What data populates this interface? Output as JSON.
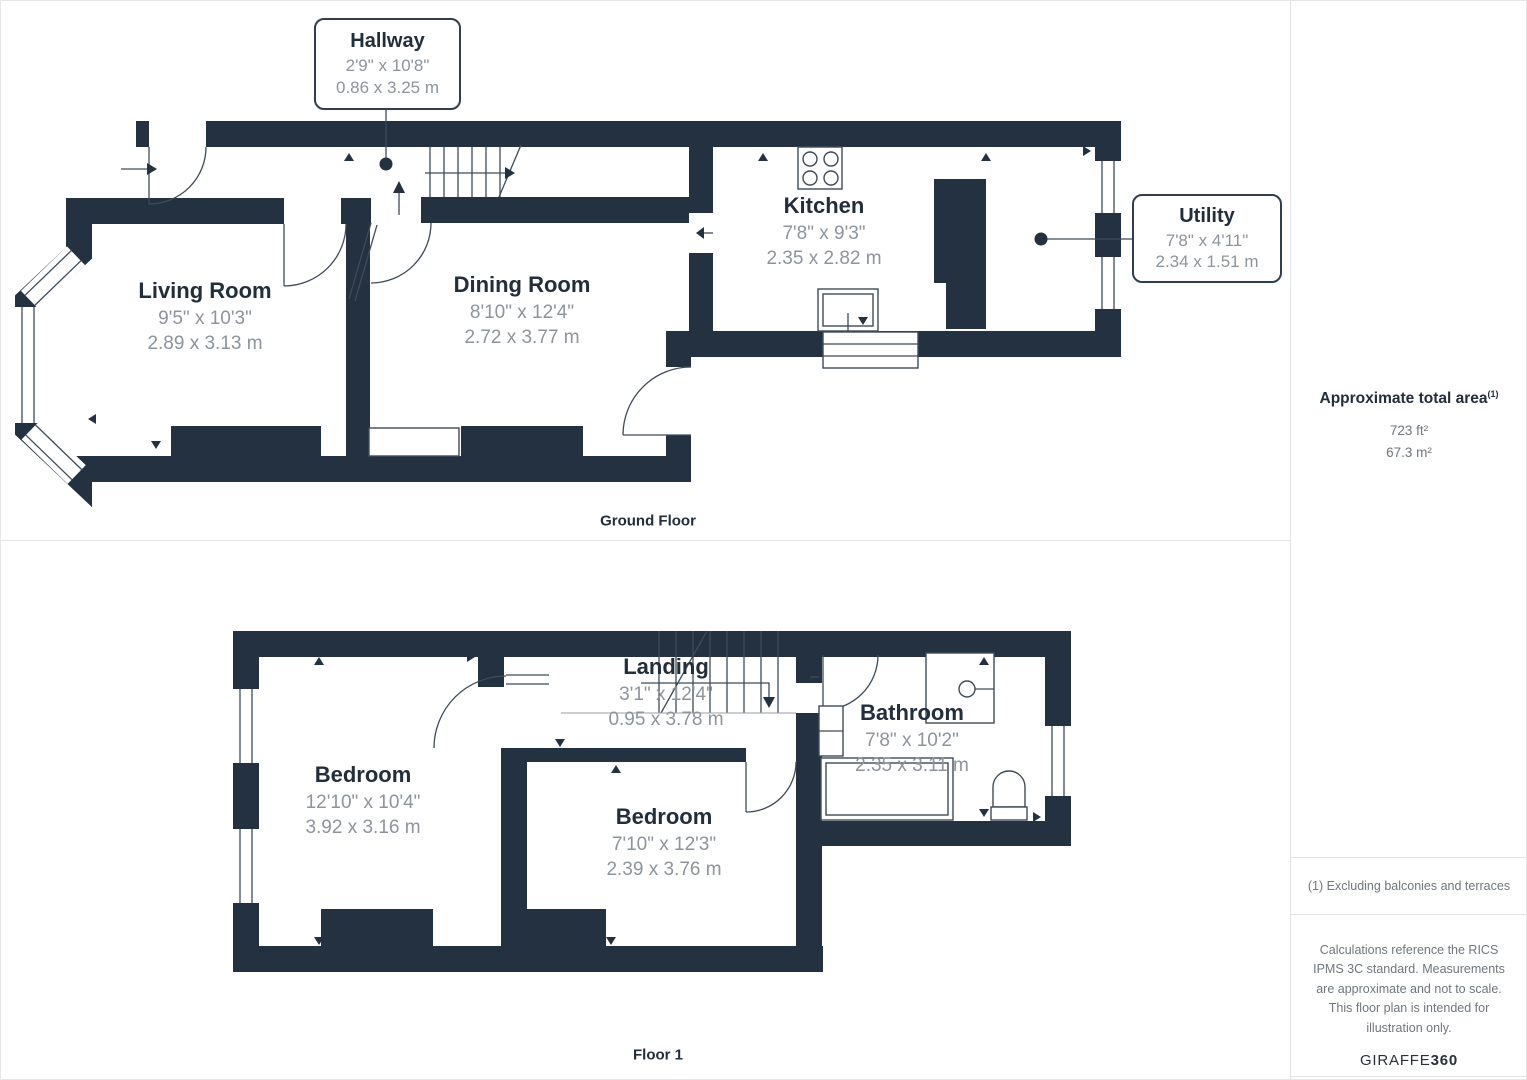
{
  "ground": {
    "label": "Ground Floor",
    "rooms": [
      {
        "name": "Living Room",
        "imperial": "9'5\" x 10'3\"",
        "metric": "2.89 x 3.13 m"
      },
      {
        "name": "Dining Room",
        "imperial": "8'10\" x 12'4\"",
        "metric": "2.72 x 3.77 m"
      },
      {
        "name": "Kitchen",
        "imperial": "7'8\" x 9'3\"",
        "metric": "2.35 x 2.82 m"
      }
    ],
    "callouts": [
      {
        "name": "Hallway",
        "imperial": "2'9\" x 10'8\"",
        "metric": "0.86 x 3.25 m"
      },
      {
        "name": "Utility",
        "imperial": "7'8\" x 4'11\"",
        "metric": "2.34 x 1.51 m"
      }
    ]
  },
  "floor1": {
    "label": "Floor 1",
    "rooms": [
      {
        "name": "Bedroom",
        "imperial": "12'10\" x 10'4\"",
        "metric": "3.92 x 3.16 m"
      },
      {
        "name": "Landing",
        "imperial": "3'1\" x 12'4\"",
        "metric": "0.95 x 3.78 m"
      },
      {
        "name": "Bedroom",
        "imperial": "7'10\" x 12'3\"",
        "metric": "2.39 x 3.76 m"
      },
      {
        "name": "Bathroom",
        "imperial": "7'8\" x 10'2\"",
        "metric": "2.35 x 3.11 m"
      }
    ]
  },
  "sidebar": {
    "total_area_title": "Approximate total area",
    "total_area_footnote_marker": "(1)",
    "area_ft": "723 ft²",
    "area_m": "67.3 m²",
    "footnote": "(1) Excluding balconies and terraces",
    "disclaimer": "Calculations reference the RICS IPMS 3C standard. Measurements are approximate and not to scale. This floor plan is intended for illustration only.",
    "brand_name": "GIRAFFE",
    "brand_suffix": "360"
  },
  "colors": {
    "wall": "#233140",
    "room_title": "#222e3c",
    "dimensions": "#8d949c",
    "panel_border": "#e3e3e3",
    "footnote_text": "#6f767d"
  }
}
